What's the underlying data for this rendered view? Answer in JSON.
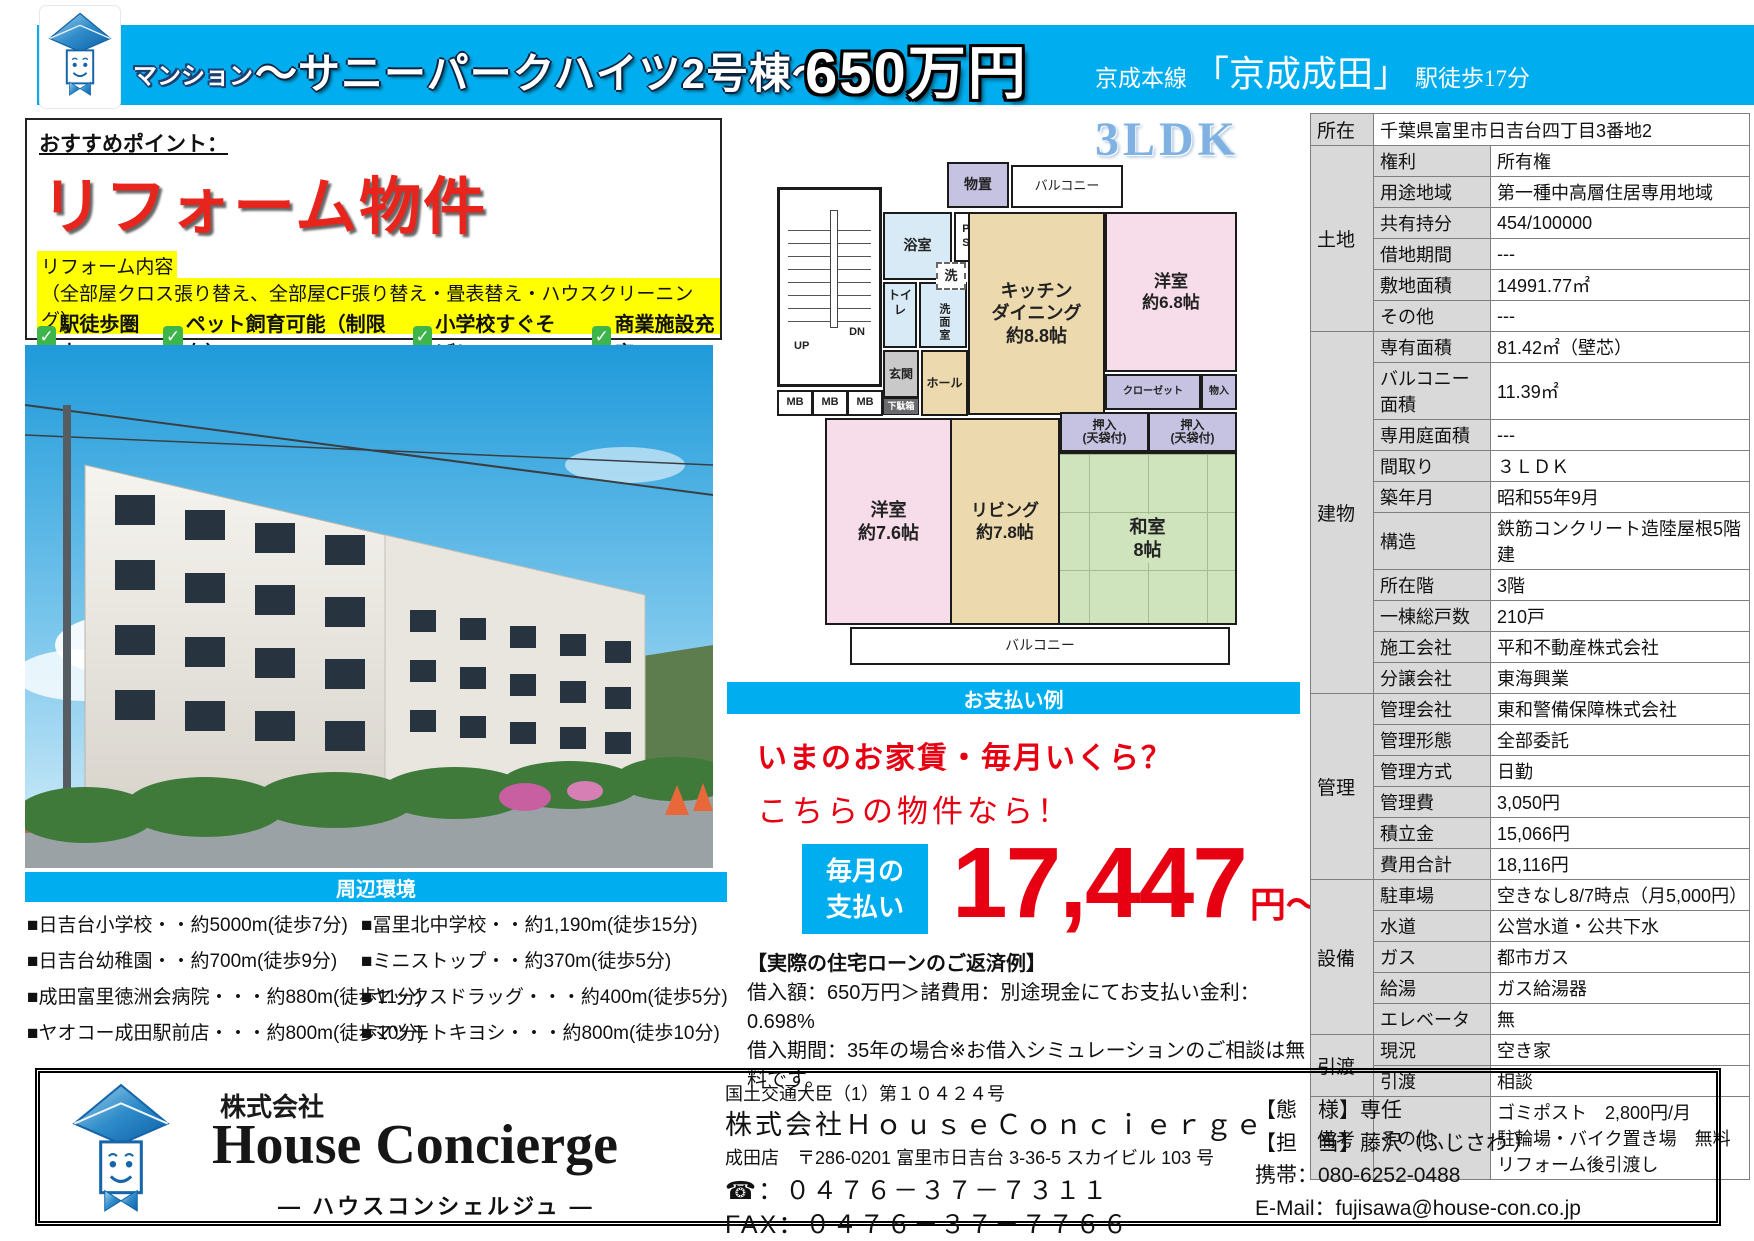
{
  "colors": {
    "accent": "#00aeef",
    "red": "#e60012",
    "highlight_yellow": "#ffff00",
    "check_green": "#3db54a",
    "plan_pink": "#f7dce9",
    "plan_tan": "#edd9ae",
    "plan_green": "#cfe3bd",
    "plan_purple": "#c6c2e2",
    "plan_blue": "#d8eaf5"
  },
  "header": {
    "category": "マンション",
    "title": "〜サニーパークハイツ2号棟〜",
    "price": "650万円",
    "rail_line": "京成本線",
    "station": "「京成成田」",
    "walk": "駅徒歩17分"
  },
  "recommend": {
    "heading": "おすすめポイント：",
    "main": "リフォーム物件",
    "reform_label": "リフォーム内容",
    "reform_detail": "（全部屋クロス張り替え、全部屋CF張り替え・畳表替え・ハウスクリーニング）",
    "checks": [
      "駅徒歩圏内",
      "ペット飼育可能（制限有）",
      "小学校すぐそば！",
      "商業施設充実"
    ]
  },
  "surroundings": {
    "heading": "周辺環境",
    "left": [
      "■日吉台小学校・・約5000m(徒歩7分)",
      "■日吉台幼稚園・・約700m(徒歩9分)",
      "■成田富里徳洲会病院・・・約880m(徒歩11分)",
      "■ヤオコー成田駅前店・・・約800m(徒歩10分)"
    ],
    "right": [
      "■冨里北中学校・・約1,190m(徒歩15分)",
      "■ミニストップ・・約370m(徒歩5分)",
      "■ヤックスドラッグ・・・約400m(徒歩5分)",
      "■マツモトキヨシ・・・約800m(徒歩10分)"
    ]
  },
  "floorplan": {
    "type": "3LDK",
    "rooms": {
      "storage": "物置",
      "balcony": "バルコニー",
      "bath": "浴室",
      "ps": "PS",
      "toilet": "トイレ",
      "wash": "洗",
      "washroom": "洗面室",
      "entrance": "玄関",
      "shoebox": "下駄箱",
      "hall": "ホール",
      "mb": "MB",
      "up": "UP",
      "dn": "DN",
      "kitchen": "キッチン\nダイニング\n約8.8帖",
      "western1": "洋室\n約6.8帖",
      "closet": "クローゼット",
      "storage2": "物入",
      "oshiire": "押入\n(天袋付)",
      "western2": "洋室\n約7.6帖",
      "living": "リビング\n約7.8帖",
      "japanese": "和室\n8帖"
    }
  },
  "payment": {
    "heading": "お支払い例",
    "q1": "いまのお家賃・毎月いくら？",
    "q2": "こちらの物件なら！",
    "monthly_label": "毎月の\n支払い",
    "amount": "17,447",
    "amount_unit": "円〜",
    "loan_title": "【実際の住宅ローンのご返済例】",
    "loan_line1": "借入額：650万円＞諸費用：別途現金にてお支払い金利：0.698%",
    "loan_line2": "借入期間：35年の場合※お借入シミュレーションのご相談は無料です。"
  },
  "details": {
    "groups": [
      {
        "name": "所在",
        "rows": [
          {
            "label": "",
            "value": "千葉県富里市日吉台四丁目3番地2",
            "full": true
          }
        ]
      },
      {
        "name": "土地",
        "rows": [
          {
            "label": "権利",
            "value": "所有権"
          },
          {
            "label": "用途地域",
            "value": "第一種中高層住居専用地域"
          },
          {
            "label": "共有持分",
            "value": "454/100000"
          },
          {
            "label": "借地期間",
            "value": "---"
          },
          {
            "label": "敷地面積",
            "value": "14991.77㎡"
          },
          {
            "label": "その他",
            "value": "---"
          }
        ]
      },
      {
        "name": "建物",
        "rows": [
          {
            "label": "専有面積",
            "value": "81.42㎡（壁芯）"
          },
          {
            "label": "バルコニー面積",
            "value": "11.39㎡"
          },
          {
            "label": "専用庭面積",
            "value": "---"
          },
          {
            "label": "間取り",
            "value": "３ＬＤＫ"
          },
          {
            "label": "築年月",
            "value": "昭和55年9月"
          },
          {
            "label": "構造",
            "value": "鉄筋コンクリート造陸屋根5階建"
          },
          {
            "label": "所在階",
            "value": "3階"
          },
          {
            "label": "一棟総戸数",
            "value": "210戸"
          },
          {
            "label": "施工会社",
            "value": "平和不動産株式会社"
          },
          {
            "label": "分譲会社",
            "value": "東海興業"
          }
        ]
      },
      {
        "name": "管理",
        "rows": [
          {
            "label": "管理会社",
            "value": "東和警備保障株式会社"
          },
          {
            "label": "管理形態",
            "value": "全部委託"
          },
          {
            "label": "管理方式",
            "value": "日勤"
          },
          {
            "label": "管理費",
            "value": "3,050円"
          },
          {
            "label": "積立金",
            "value": "15,066円"
          },
          {
            "label": "費用合計",
            "value": "18,116円"
          }
        ]
      },
      {
        "name": "設備",
        "rows": [
          {
            "label": "駐車場",
            "value": "空きなし8/7時点（月5,000円）"
          },
          {
            "label": "水道",
            "value": "公営水道・公共下水"
          },
          {
            "label": "ガス",
            "value": "都市ガス"
          },
          {
            "label": "給湯",
            "value": "ガス給湯器"
          },
          {
            "label": "エレベータ",
            "value": "無"
          }
        ]
      },
      {
        "name": "引渡",
        "rows": [
          {
            "label": "現況",
            "value": "空き家"
          },
          {
            "label": "引渡",
            "value": "相談"
          }
        ]
      },
      {
        "name": "備考",
        "rows": [
          {
            "label": "その他",
            "value": [
              "ゴミポスト　2,800円/月",
              "駐輪場・バイク置き場　無料",
              "リフォーム後引渡し"
            ]
          }
        ]
      }
    ]
  },
  "footer": {
    "brand_prefix": "株式会社",
    "brand": "House Concierge",
    "brand_kana": "― ハウスコンシェルジュ ―",
    "license": "国土交通大臣（1）第１０４２４号",
    "company": "株式会社ＨｏｕｓｅＣｏｎｃｉｅｒｇｅ",
    "branch": "成田店　〒286-0201 富里市日吉台 3-36-5 スカイビル 103 号",
    "tel": "☎：０４７６－３７－７３１１",
    "fax": "FAX：０４７６－３７－７７６６",
    "type": "【態　様】専任",
    "agent": "【担　当】藤沢（ふじさわ ）",
    "mobile": "携帯：080-6252-0488",
    "email": "E-Mail：fujisawa@house-con.co.jp"
  }
}
